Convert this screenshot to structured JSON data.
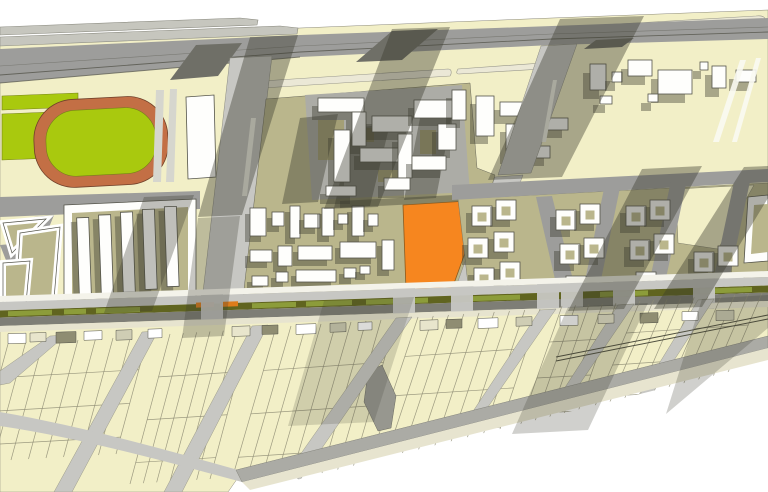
{
  "title": "",
  "map": {
    "type": "urban-masterplan-site-plan",
    "visible_text": [],
    "legend_features": [
      {
        "name": "highlighted-development-parcel",
        "color": "#F6861F"
      },
      {
        "name": "sports-field",
        "color": "#A9C90E"
      },
      {
        "name": "running-track",
        "color": "#C36F45"
      },
      {
        "name": "block-interior",
        "color": "#BAB68C"
      },
      {
        "name": "parcel-fabric",
        "color": "#F2EFC7"
      },
      {
        "name": "roadway",
        "color": "#9D9D9B"
      },
      {
        "name": "tram-median",
        "color": "#60641F"
      },
      {
        "name": "tram-platform",
        "color": "#DD7C1C"
      },
      {
        "name": "building",
        "color": "#FEFEFC"
      }
    ]
  },
  "palette": {
    "background": "#FFFFFF",
    "parcel_cream": "#F2EFC7",
    "verge_cream": "#E7E4CF",
    "block_khaki": "#BAB68C",
    "road_gray": "#9D9D9B",
    "road_light": "#C7C7C3",
    "road_dark": "#7E7E76",
    "building_white": "#FEFEFC",
    "outline": "#54544A",
    "shadow": "rgba(58,58,46,0.40)",
    "highlight_parcel": "#F6861F",
    "sports_field_green": "#A9C90E",
    "running_track": "#C36F45",
    "median_olive": "#60641F",
    "median_green": "#8C9C3A",
    "tram_platform_orange": "#DD7C1C",
    "platform_cream": "#EBE8D6",
    "platform_gray": "#C6C6BE"
  }
}
